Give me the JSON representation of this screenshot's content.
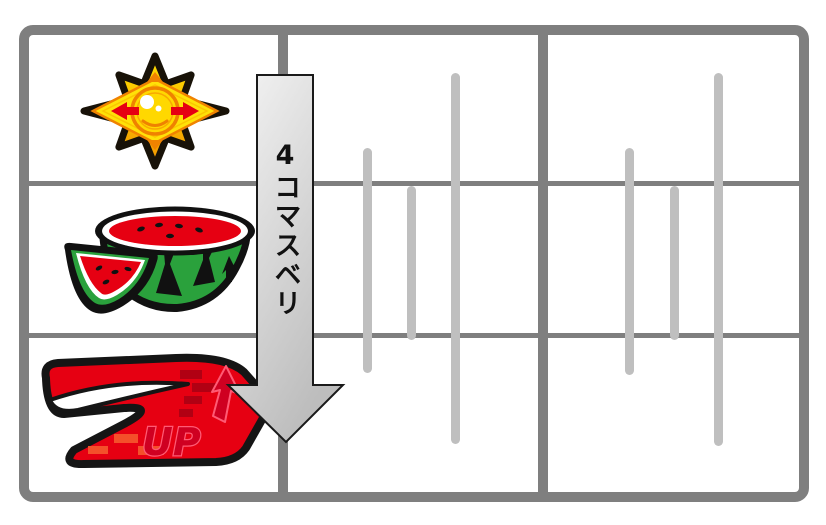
{
  "canvas": {
    "width": 826,
    "height": 525,
    "background": "#ffffff"
  },
  "diagram": {
    "name": "pachislo-reel-slip-diagram",
    "grid": {
      "columns": 3,
      "rows": 3,
      "border_color": "#7f7f7f",
      "tick_color": "#bfbfbf"
    },
    "arrow": {
      "label": "4コマスベリ",
      "fill_light": "#f5f5f5",
      "fill_dark": "#bdbdbd",
      "outline_color": "#1a1a1a",
      "text_color": "#111111"
    },
    "symbols": [
      {
        "name": "star",
        "cell": "left-row-1",
        "color": "#ffd800"
      },
      {
        "name": "watermelon",
        "cell": "left-row-2",
        "color": "#22ac38"
      },
      {
        "name": "seven-up",
        "cell": "left-row-3",
        "color": "#e60012",
        "text": "UP"
      }
    ],
    "ticks": [
      {
        "panel": "middle",
        "x": 363,
        "top": 148,
        "height": 225
      },
      {
        "panel": "middle",
        "x": 407,
        "top": 186,
        "height": 154
      },
      {
        "panel": "middle",
        "x": 451,
        "top": 73,
        "height": 371
      },
      {
        "panel": "right",
        "x": 625,
        "top": 148,
        "height": 227
      },
      {
        "panel": "right",
        "x": 670,
        "top": 186,
        "height": 154
      },
      {
        "panel": "right",
        "x": 714,
        "top": 73,
        "height": 373
      }
    ]
  }
}
